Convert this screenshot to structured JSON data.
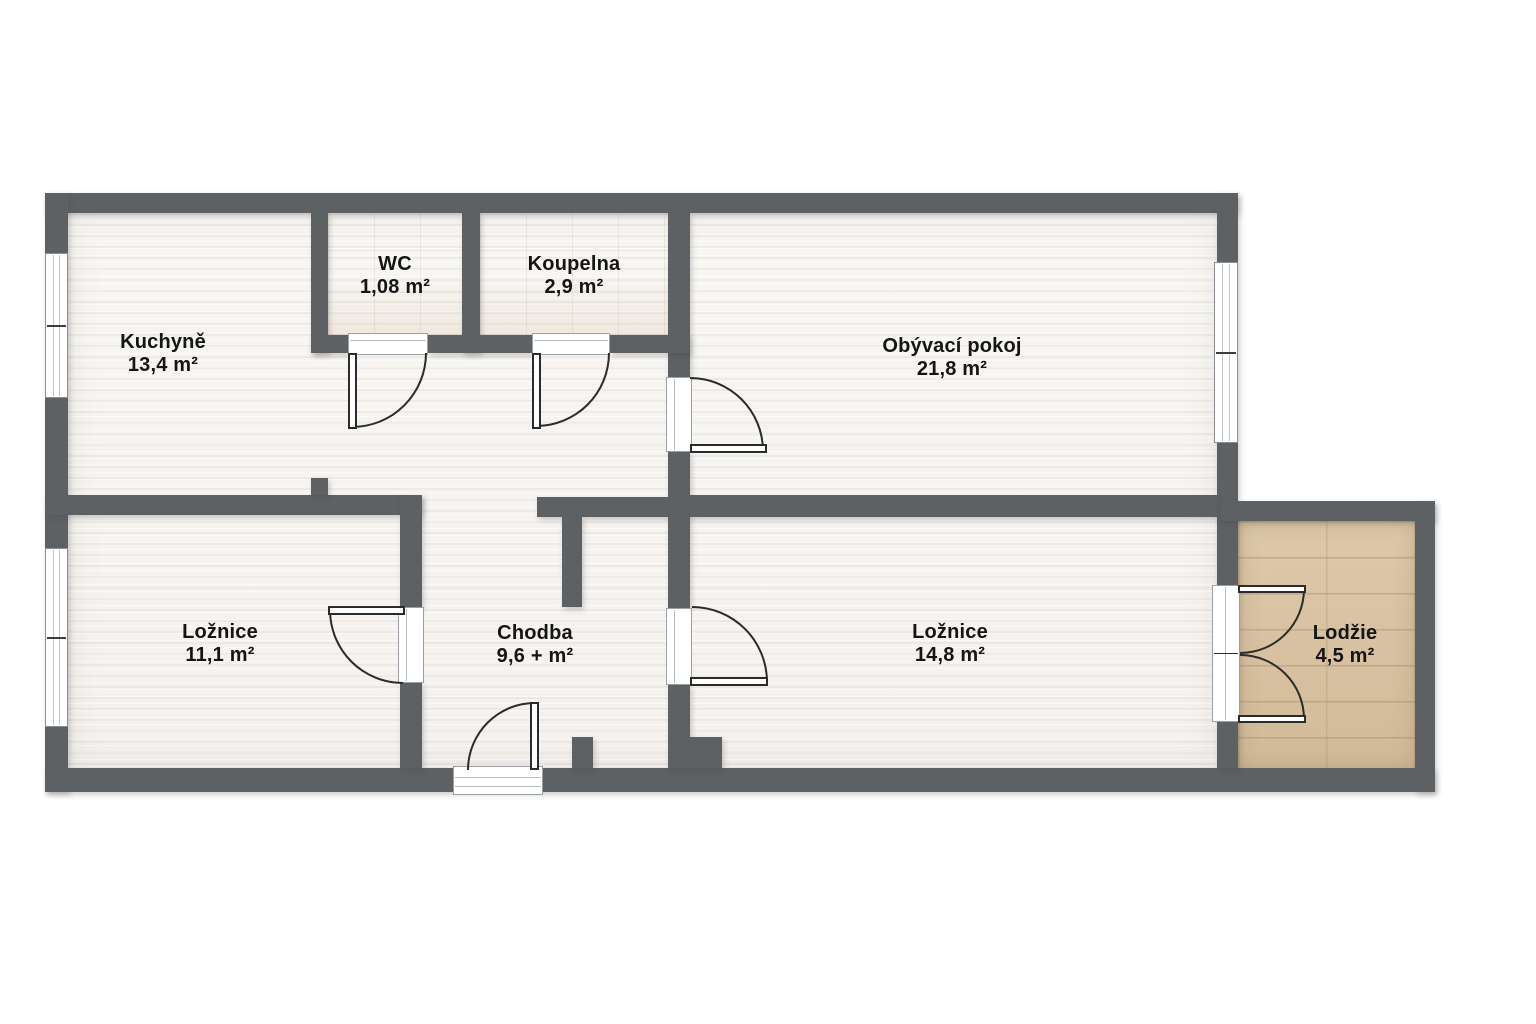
{
  "plan": {
    "type": "apartment-floor-plan",
    "colors": {
      "background": "#ffffff",
      "wall": "#5d6164",
      "floor": "#f6f3f0",
      "loggia_wood": "#d8c1a1",
      "door_line": "#2b2b2b",
      "label_text": "#151515"
    }
  },
  "rooms": [
    {
      "name": "Kuchyně",
      "area": "13,4 m²"
    },
    {
      "name": "WC",
      "area": "1,08 m²"
    },
    {
      "name": "Koupelna",
      "area": "2,9 m²"
    },
    {
      "name": "Obývací pokoj",
      "area": "21,8 m²"
    },
    {
      "name": "Ložnice",
      "area": "11,1 m²"
    },
    {
      "name": "Chodba",
      "area": "9,6 + m²"
    },
    {
      "name": "Ložnice",
      "area": "14,8 m²"
    },
    {
      "name": "Lodžie",
      "area": "4,5 m²"
    }
  ]
}
